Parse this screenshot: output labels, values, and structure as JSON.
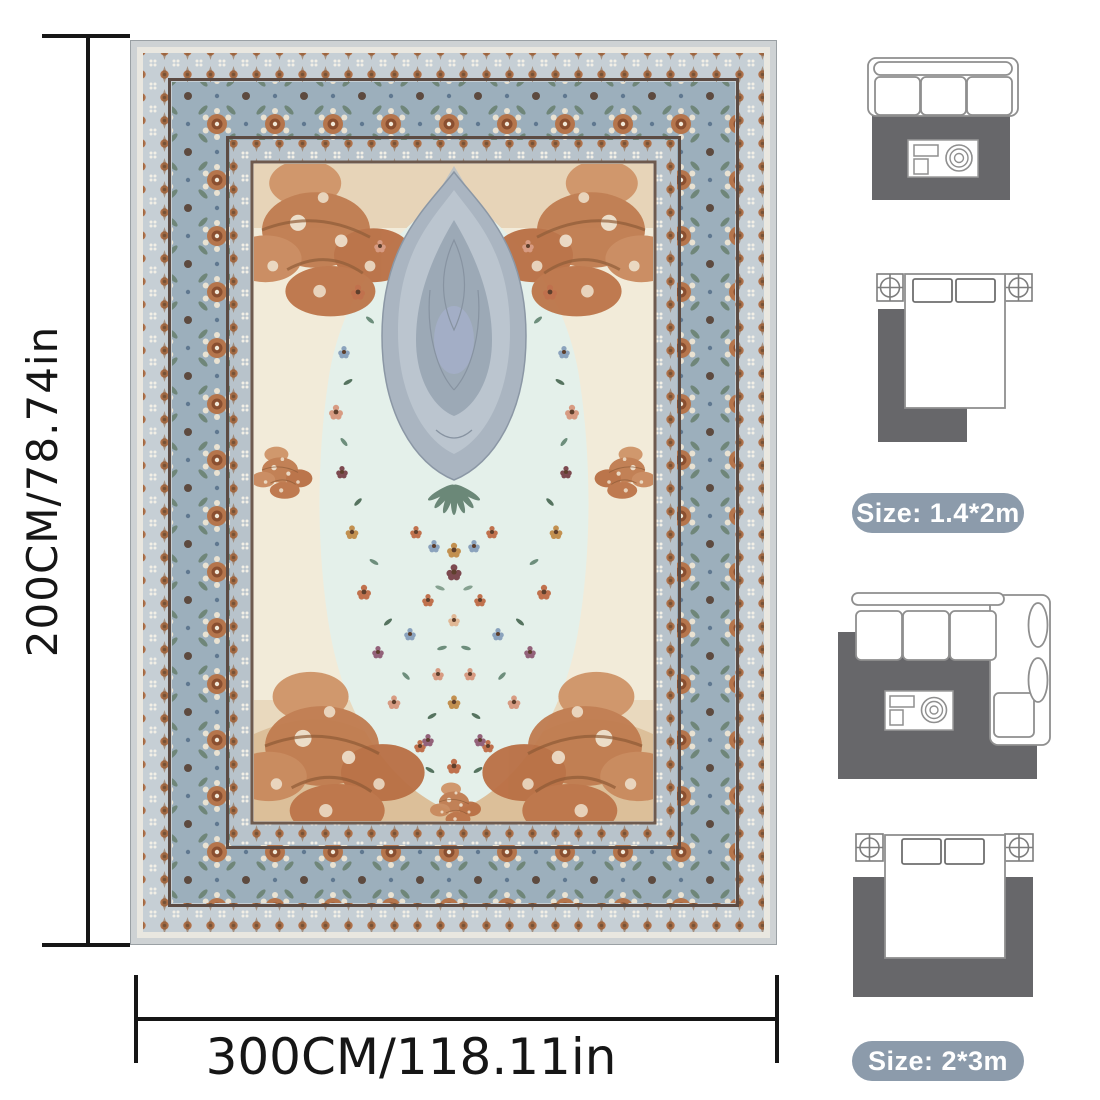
{
  "page": {
    "background_color": "#ffffff",
    "description_name": "rug-product-size-guide-image"
  },
  "dimension_annotations": {
    "vertical": {
      "label": "200CM/78.74in"
    },
    "horizontal": {
      "label": "300CM/118.11in"
    },
    "line_color": "#161616"
  },
  "product_photo": {
    "name": "persian-style-area-rug",
    "colors": {
      "edge_gray": "#ced2d4",
      "guard_band": "#c6cfd5",
      "main_border_blue_gray": "#9cafbc",
      "inner_guard_band": "#b8c3cb",
      "separator_brown": "#5c4b43",
      "field_cream": "#f2ebd9",
      "field_mint": "#e4f0ea",
      "accent_rust": "#bd7549",
      "medallion_gray": "#aab5c1"
    }
  },
  "size_guide": {
    "badge_bg_color": "#8c9bab",
    "badge_text_color": "#ffffff",
    "diagram_rug_color": "#67676a",
    "furniture_outline_color": "#8f8f8f",
    "groups": [
      {
        "size_label": "Size: 1.4*2m",
        "diagrams": [
          "three-seat-sofa-with-rug-top-view",
          "bed-with-nightstands-and-rug-top-view"
        ]
      },
      {
        "size_label": "Size: 2*3m",
        "diagrams": [
          "sectional-sofa-with-rug-top-view",
          "bed-with-nightstands-and-large-rug-top-view"
        ]
      }
    ]
  }
}
